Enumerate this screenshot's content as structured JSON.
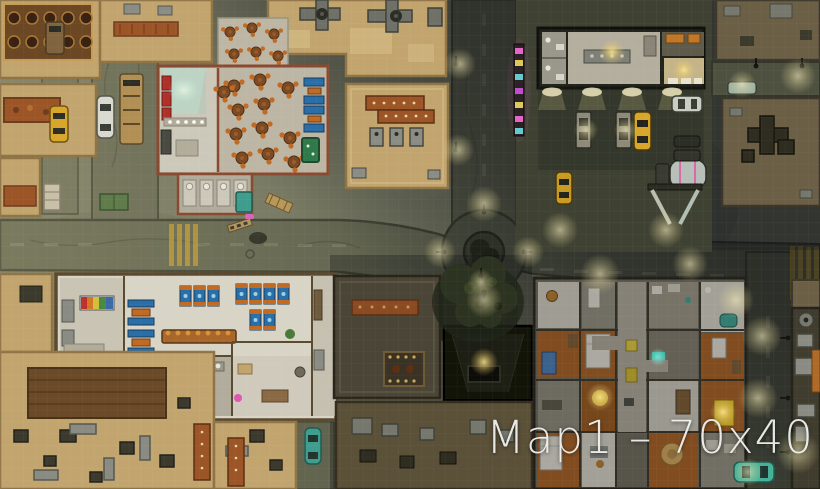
{
  "title": {
    "label": "Map1 – 70x40"
  },
  "grid": {
    "cols": 70,
    "rows": 40
  },
  "palette": {
    "ground": "#787a62",
    "asphalt": "#6b6e57",
    "asphaltDark": "#565a46",
    "curb": "#41442f",
    "tan": "#c2a56e",
    "tanLight": "#d9c28c",
    "tanWall": "#8f7445",
    "roofDim": "#6b5f46",
    "darkRoof": "#3c3a2c",
    "rust": "#9c5526",
    "floorGray": "#bdb6a5",
    "floorWhite": "#d8d4c6",
    "red": "#b03028",
    "tableBrown": "#7c4a22",
    "chairOrange": "#c06a24",
    "boothBlue": "#2a6ea8",
    "poolGreen": "#2e7a4a",
    "counterOrange": "#a8662a",
    "aptOrange": "#a35f24",
    "vaultDark": "#131408",
    "glowWarm": "#f0e2a0",
    "glowTeal": "#4fd8c4",
    "teal": "#3f9d8d",
    "taxiYellow": "#d7a62a",
    "carWhite": "#d9d9d0",
    "busTan": "#b29055",
    "vanBrown": "#80643f",
    "darkCar": "#2c2e26",
    "tanker": "#c2c8c2",
    "neonPink": "#e466c8",
    "neonYellow": "#ddd052",
    "neonCyan": "#5cd2ce",
    "neonMagenta": "#c04ad0",
    "benchGreen": "#5f7c4a",
    "treeDark": "#2c3320",
    "shadow": "#0a0c12",
    "titleWhite": "#f2f2ee"
  }
}
